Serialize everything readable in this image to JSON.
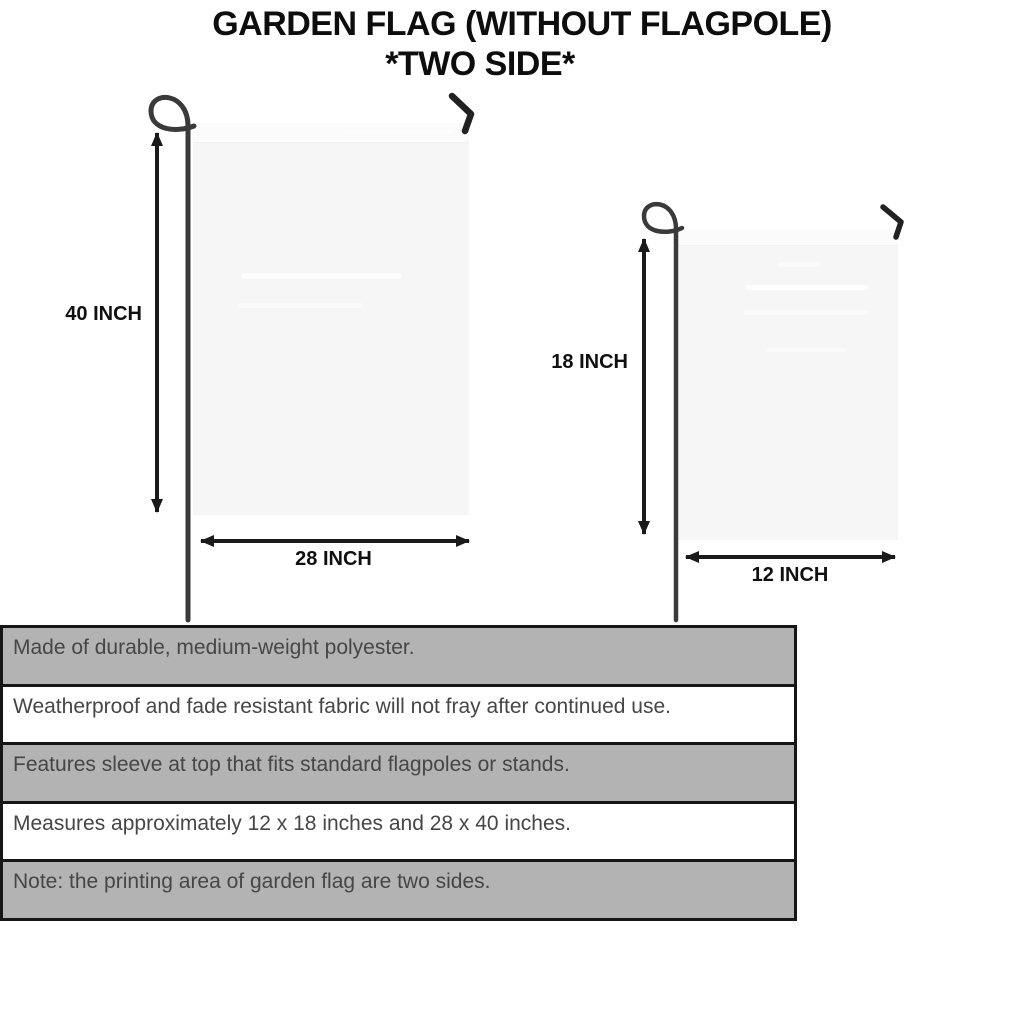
{
  "header": {
    "title": "GARDEN FLAG (WITHOUT FLAGPOLE)",
    "subtitle": "*TWO SIDE*"
  },
  "diagram": {
    "large_flag": {
      "height_label": "40 INCH",
      "width_label": "28 INCH"
    },
    "small_flag": {
      "height_label": "18 INCH",
      "width_label": "12 INCH"
    }
  },
  "features": [
    "Made of durable, medium-weight polyester.",
    "Weatherproof and fade resistant fabric will not fray after continued use.",
    "Features sleeve at top that fits standard flagpoles or stands.",
    "Measures approximately 12 x 18 inches and 28 x 40 inches.",
    "Note: the printing area of garden flag are two sides."
  ],
  "colors": {
    "row_gray": "#b3b3b3",
    "row_white": "#ffffff",
    "panel_border": "#161616",
    "flag_fill": "#f6f6f6",
    "pole": "#3a3a3a",
    "arrow": "#1a1a1a",
    "title_text": "#0d0d0d",
    "feature_text": "#464646"
  }
}
